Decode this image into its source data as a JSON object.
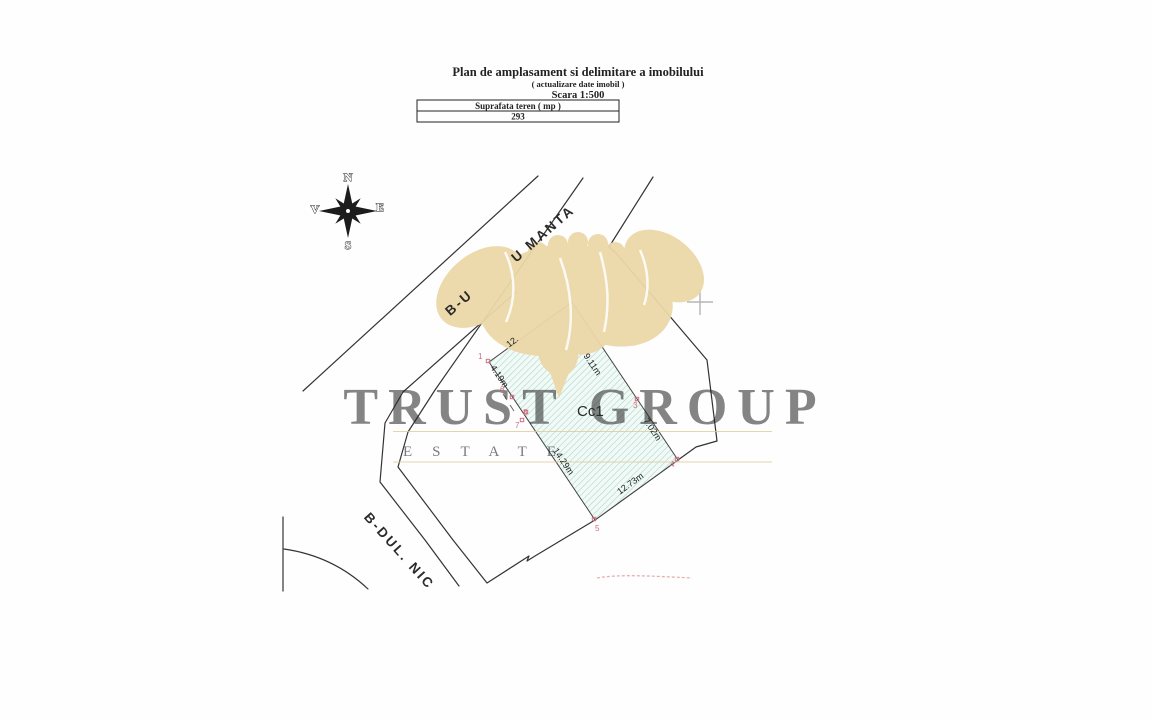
{
  "title_block": {
    "title": "Plan de amplasament si delimitare a imobilului",
    "subtitle": "( actualizare date imobil )",
    "scale": "Scara 1:500"
  },
  "area_table": {
    "header": "Suprafata teren ( mp )",
    "value": "293"
  },
  "compass": {
    "north": "N",
    "south": "S",
    "east": "E",
    "west": "V"
  },
  "streets": {
    "banu_manta_fragment_lower": "B-U",
    "banu_manta_fragment_upper": "U  MANTA",
    "nicolae_fragment": "B-DUL.   NIC"
  },
  "parcel": {
    "label": "Cc1",
    "fill": "#f1faf6",
    "hatch_color": "#aed6ca",
    "marker_color": "#cf6f80",
    "dimensions": [
      {
        "value": "12."
      },
      {
        "value": "9.11m"
      },
      {
        "value": "4.19m"
      },
      {
        "value": "7.02m"
      },
      {
        "value": "14.29m"
      },
      {
        "value": "12.73m"
      }
    ],
    "points": [
      "1",
      "3",
      "4",
      "5",
      "6",
      "7",
      "8"
    ]
  },
  "watermark": {
    "line1": "TRUST GROUP",
    "line2": "ESTATE",
    "color": "#d9bd86"
  }
}
